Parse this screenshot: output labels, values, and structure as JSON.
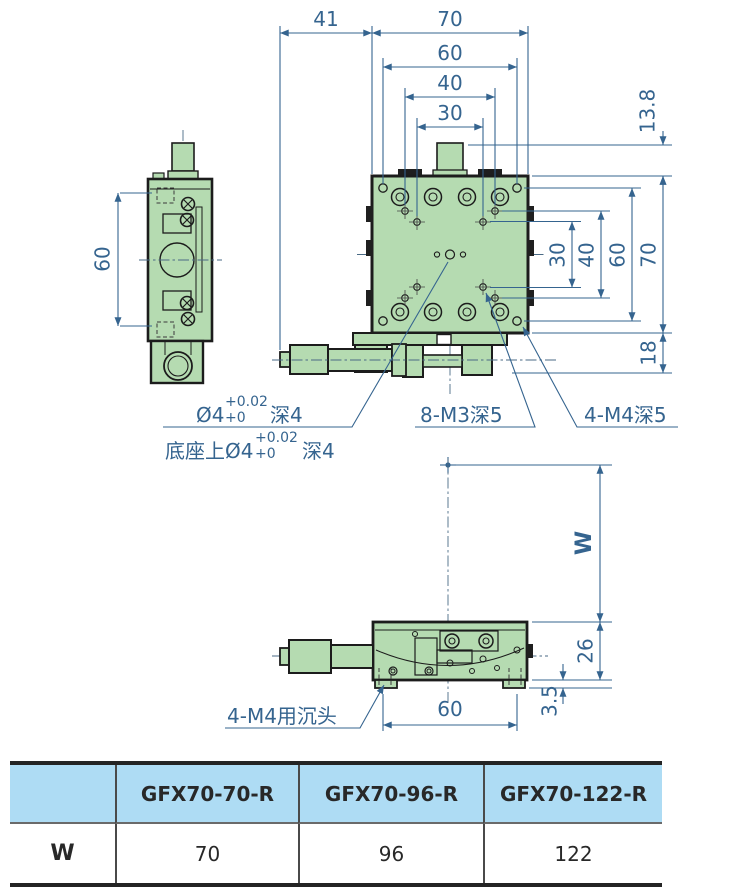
{
  "colors": {
    "dimension_blue": "#35648f",
    "body_green": "#b5dbb1",
    "outline_black": "#1c1c1c",
    "table_header_bg": "#aedcf4",
    "table_border": "#242424"
  },
  "top_dims": {
    "offset_left": "41",
    "width": "70",
    "d60": "60",
    "d40": "40",
    "d30": "30"
  },
  "right_dims": {
    "d13_8": "13.8",
    "d70": "70",
    "d60": "60",
    "d40": "40",
    "d30": "30",
    "d18": "18"
  },
  "side_dims": {
    "height": "60"
  },
  "front_dims": {
    "travel": "W",
    "height": "26",
    "foot": "3.5",
    "hole_span": "60"
  },
  "notes": {
    "top_hole_dia": "Ø4",
    "tol_upper": "+0.02",
    "tol_lower": "+0",
    "depth": "深4",
    "base_hole_prefix": "底座上Ø4",
    "m3_holes": "8-M3深5",
    "m4_holes": "4-M4深5",
    "m4_counterbore": "4-M4用沉头"
  },
  "table": {
    "headers": [
      "",
      "GFX70-70-R",
      "GFX70-96-R",
      "GFX70-122-R"
    ],
    "row_label": "W",
    "values": [
      "70",
      "96",
      "122"
    ]
  }
}
